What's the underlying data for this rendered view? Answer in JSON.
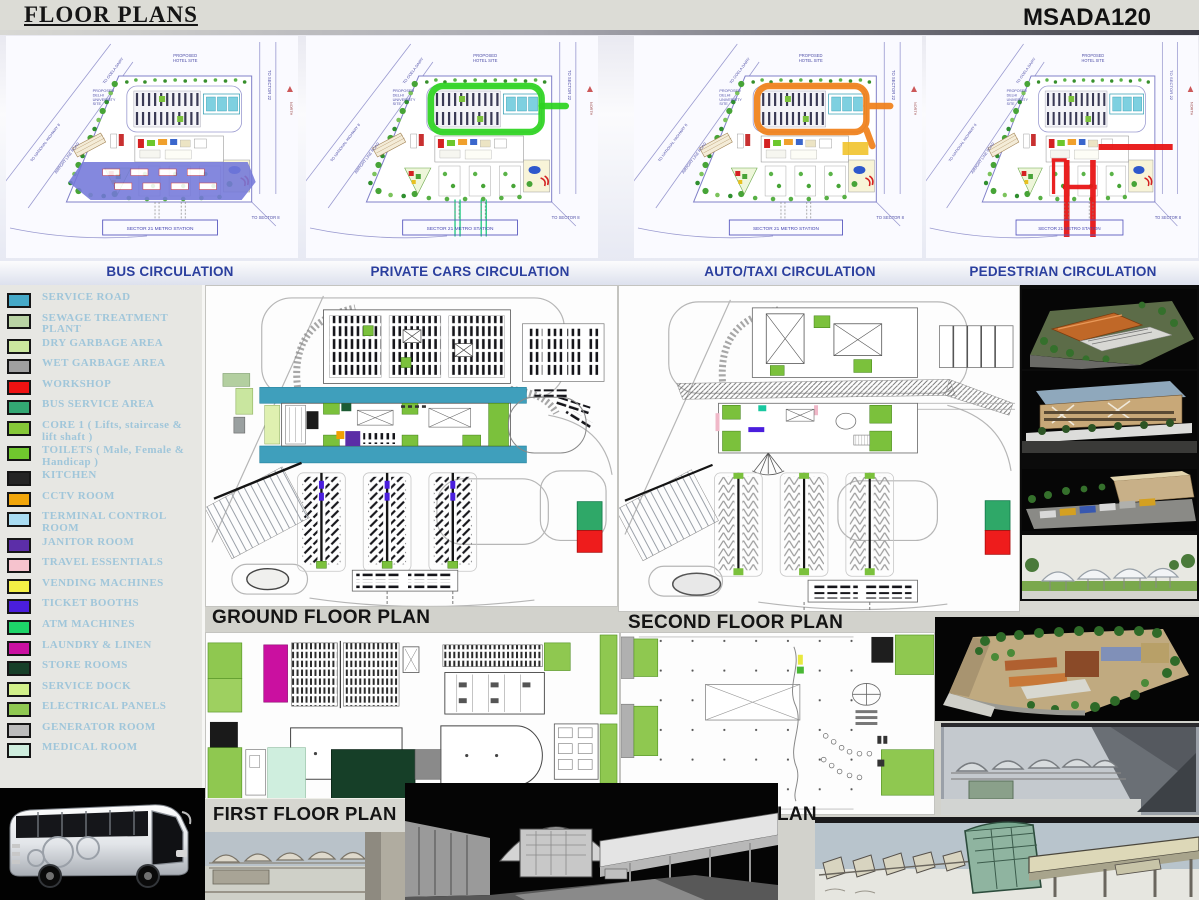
{
  "header": {
    "title": "FLOOR PLANS",
    "project_code": "MSADA120"
  },
  "circulation_plans": [
    {
      "label": "BUS CIRCULATION",
      "type": "bus",
      "highlight": "#7478da"
    },
    {
      "label": "PRIVATE CARS CIRCULATION",
      "type": "cars",
      "highlight": "#2bd41e"
    },
    {
      "label": "AUTO/TAXI CIRCULATION",
      "type": "auto",
      "highlight": "#f08018"
    },
    {
      "label": "PEDESTRIAN CIRCULATION",
      "type": "ped",
      "highlight": "#e81616"
    }
  ],
  "site_plan_labels": {
    "hotel_site": "PROPOSED HOTEL SITE",
    "university_site": "PROPOSED DELHI UNIVERSITY SITE",
    "metro_station": "SECTOR 21 METRO STATION",
    "to_sector_8": "TO SECTOR 8",
    "to_sector_22": "TO SECTOR 22",
    "national_highway": "TO NATIONAL HIGHWAY 8",
    "airport_line_road": "AIRPORT LINE ROAD",
    "goela_dairy": "TO GOELA DAIRY",
    "north": "NORTH"
  },
  "legend": {
    "items": [
      {
        "label": "SERVICE ROAD",
        "color": "#45a9c8"
      },
      {
        "label": "SEWAGE TREATMENT PLANT",
        "color": "#b9d3a4"
      },
      {
        "label": "DRY GARBAGE AREA",
        "color": "#cbe79e"
      },
      {
        "label": "WET GARBAGE AREA",
        "color": "#a0a0a0"
      },
      {
        "label": "WORKSHOP",
        "color": "#ee1212"
      },
      {
        "label": "BUS SERVICE AREA",
        "color": "#33a873"
      },
      {
        "label": "CORE 1 ( Lifts, staircase & lift shaft )",
        "color": "#86c838"
      },
      {
        "label": "TOILETS ( Male, Female & Handicap )",
        "color": "#70c72e"
      },
      {
        "label": "KITCHEN",
        "color": "#242424"
      },
      {
        "label": "CCTV ROOM",
        "color": "#f2a60a"
      },
      {
        "label": "TERMINAL CONTROL ROOM",
        "color": "#a9dcf2"
      },
      {
        "label": "JANITOR ROOM",
        "color": "#5c2ea8"
      },
      {
        "label": "TRAVEL ESSENTIALS",
        "color": "#f6c3ce"
      },
      {
        "label": "VENDING MACHINES",
        "color": "#f3ef45"
      },
      {
        "label": "TICKET BOOTHS",
        "color": "#4a1edd"
      },
      {
        "label": "ATM MACHINES",
        "color": "#1dd468"
      },
      {
        "label": "LAUNDRY & LINEN",
        "color": "#ca10a0"
      },
      {
        "label": "STORE ROOMS",
        "color": "#163f28"
      },
      {
        "label": "SERVICE DOCK",
        "color": "#d2f08a"
      },
      {
        "label": "ELECTRICAL PANELS",
        "color": "#90c952"
      },
      {
        "label": "GENERATOR ROOM",
        "color": "#bcbcbc"
      },
      {
        "label": "MEDICAL ROOM",
        "color": "#cfeede"
      }
    ]
  },
  "floor_plans": {
    "ground": "GROUND FLOOR PLAN",
    "second": "SECOND FLOOR PLAN",
    "first": "FIRST FLOOR PLAN",
    "third_partial": "LAN"
  }
}
